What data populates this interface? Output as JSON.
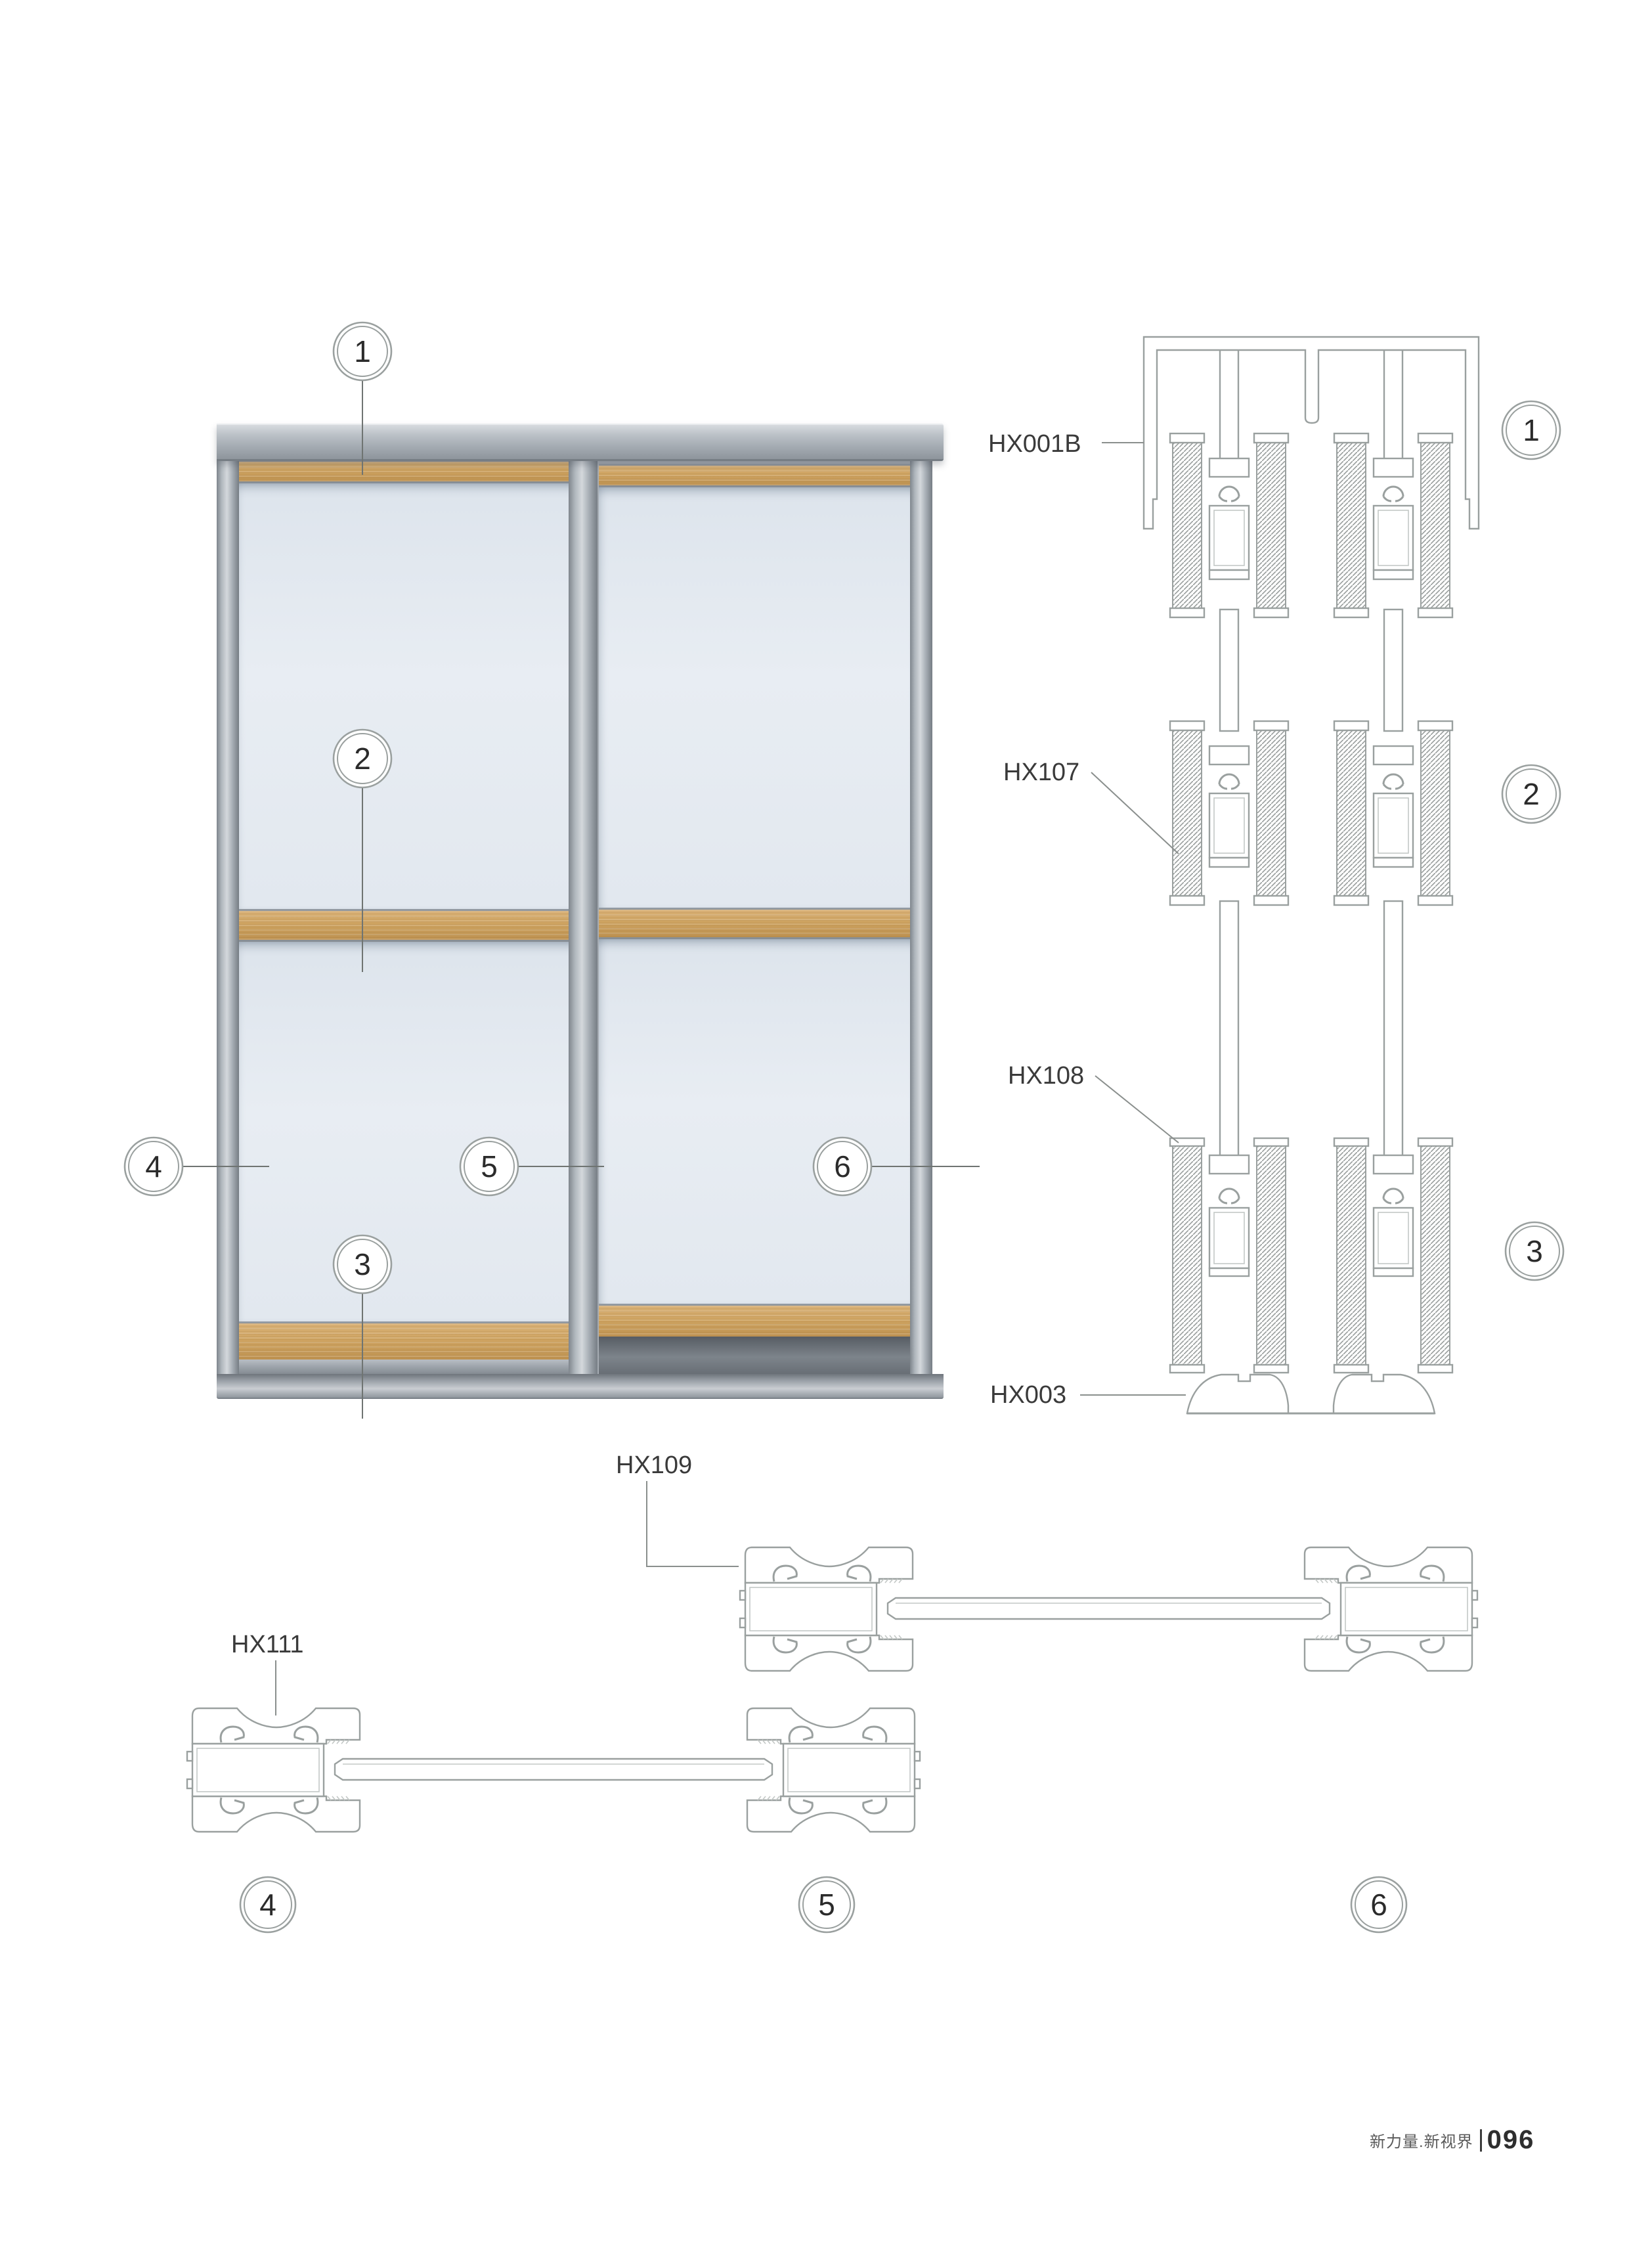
{
  "footer": {
    "brand": "新力量.新视界",
    "page": "096"
  },
  "labels": {
    "hx001b": "HX001B",
    "hx107": "HX107",
    "hx108": "HX108",
    "hx003": "HX003",
    "hx109": "HX109",
    "hx111": "HX111"
  },
  "callouts": {
    "c1": "1",
    "c2": "2",
    "c3": "3",
    "c4": "4",
    "c5": "5",
    "c6": "6"
  },
  "drawing": {
    "type": "aluminium sliding wardrobe door system",
    "views": [
      "door elevation with callouts 1-6",
      "vertical section: top track HX001B, mid rail HX107, bottom rail HX108, floor track HX003 (details 1-3)",
      "horizontal section: stile profiles HX109 and HX111 with infill panels (details 4-6)"
    ]
  }
}
